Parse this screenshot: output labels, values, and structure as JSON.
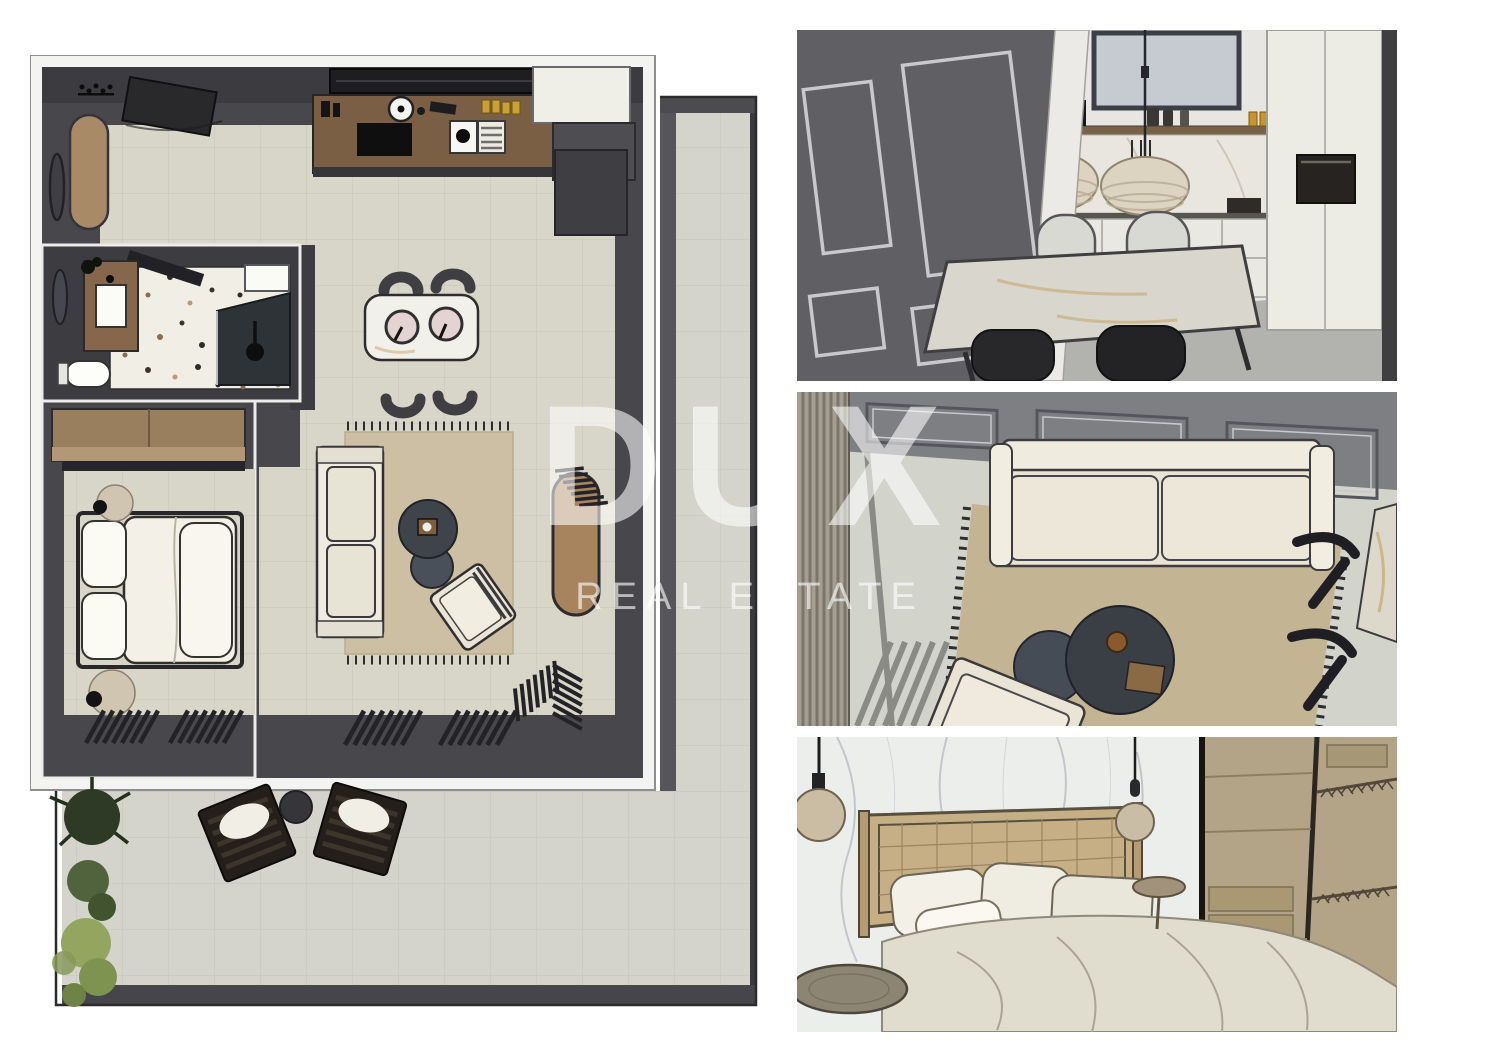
{
  "watermark": {
    "title": "DUX",
    "subtitle": "REAL ESTATE"
  },
  "palette": {
    "page_background": "#ffffff",
    "plan_wall_dark": "#46464a",
    "plan_wall_darker": "#3c3c40",
    "plan_frame_white": "#f3f3f1",
    "plan_floor_beige": "#d8d5c9",
    "terrace_floor": "#d4d4cc",
    "wood_tan": "#a98a67",
    "kitchen_counter_wood": "#7b5f44",
    "terrazzo_white": "#f1eee6",
    "rug_beige": "#cdbfa3",
    "jute_rug": "#c3b494",
    "render_wall_gray": "#606064",
    "render_panel_wall": "#7e7f83",
    "render_floor_gray": "#b2b3af",
    "marble_white": "#eceeec",
    "wardrobe_wood": "#b3a488",
    "accent_amber": "#c9a033",
    "dark_furniture": "#2a2a2d",
    "watermark_white": "rgba(255,255,255,0.6)"
  },
  "floor_plan": {
    "type": "apartment-top-view-3d",
    "rooms": [
      "entry-hall",
      "kitchen",
      "dining-area",
      "living-room",
      "bathroom",
      "bedroom",
      "terrace"
    ]
  },
  "renders": [
    {
      "id": "dining-kitchen",
      "view": "perspective"
    },
    {
      "id": "living-room",
      "view": "top-down"
    },
    {
      "id": "bedroom",
      "view": "perspective"
    }
  ]
}
